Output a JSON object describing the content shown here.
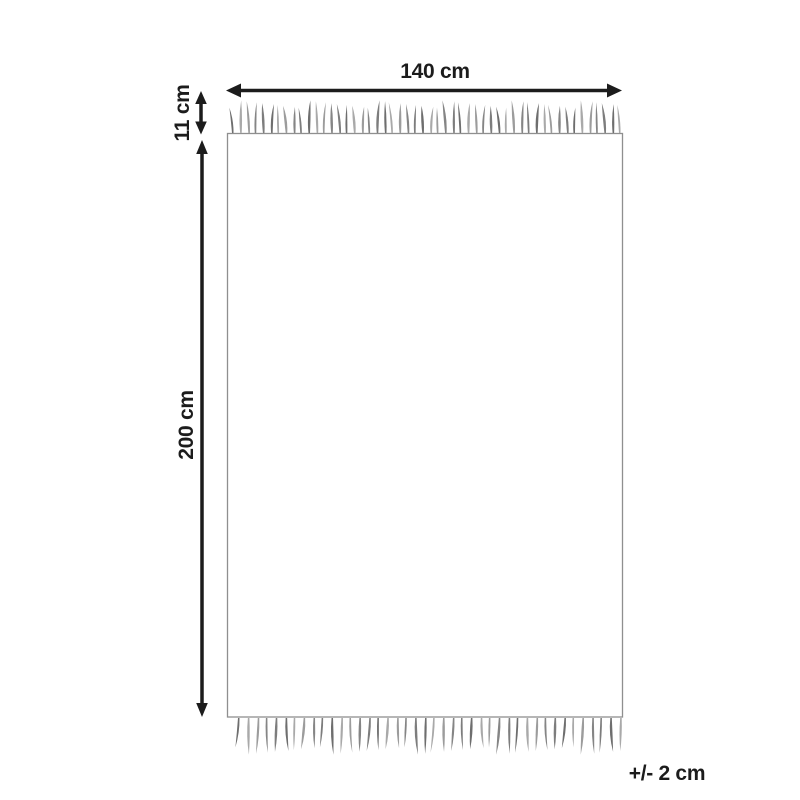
{
  "diagram": {
    "width_label": "140 cm",
    "fringe_label": "11 cm",
    "height_label": "200 cm",
    "tolerance_label": "+/- 2 cm",
    "colors": {
      "arrow": "#1c1c1c",
      "text": "#1c1c1c",
      "rect_border": "#8f8f8f",
      "tassel_palette": [
        "#6e6e6e",
        "#9c9c9c",
        "#7d7d7d",
        "#a9a9a9",
        "#858585"
      ]
    },
    "fringe": {
      "top_count": 52,
      "bottom_count": 42
    }
  }
}
